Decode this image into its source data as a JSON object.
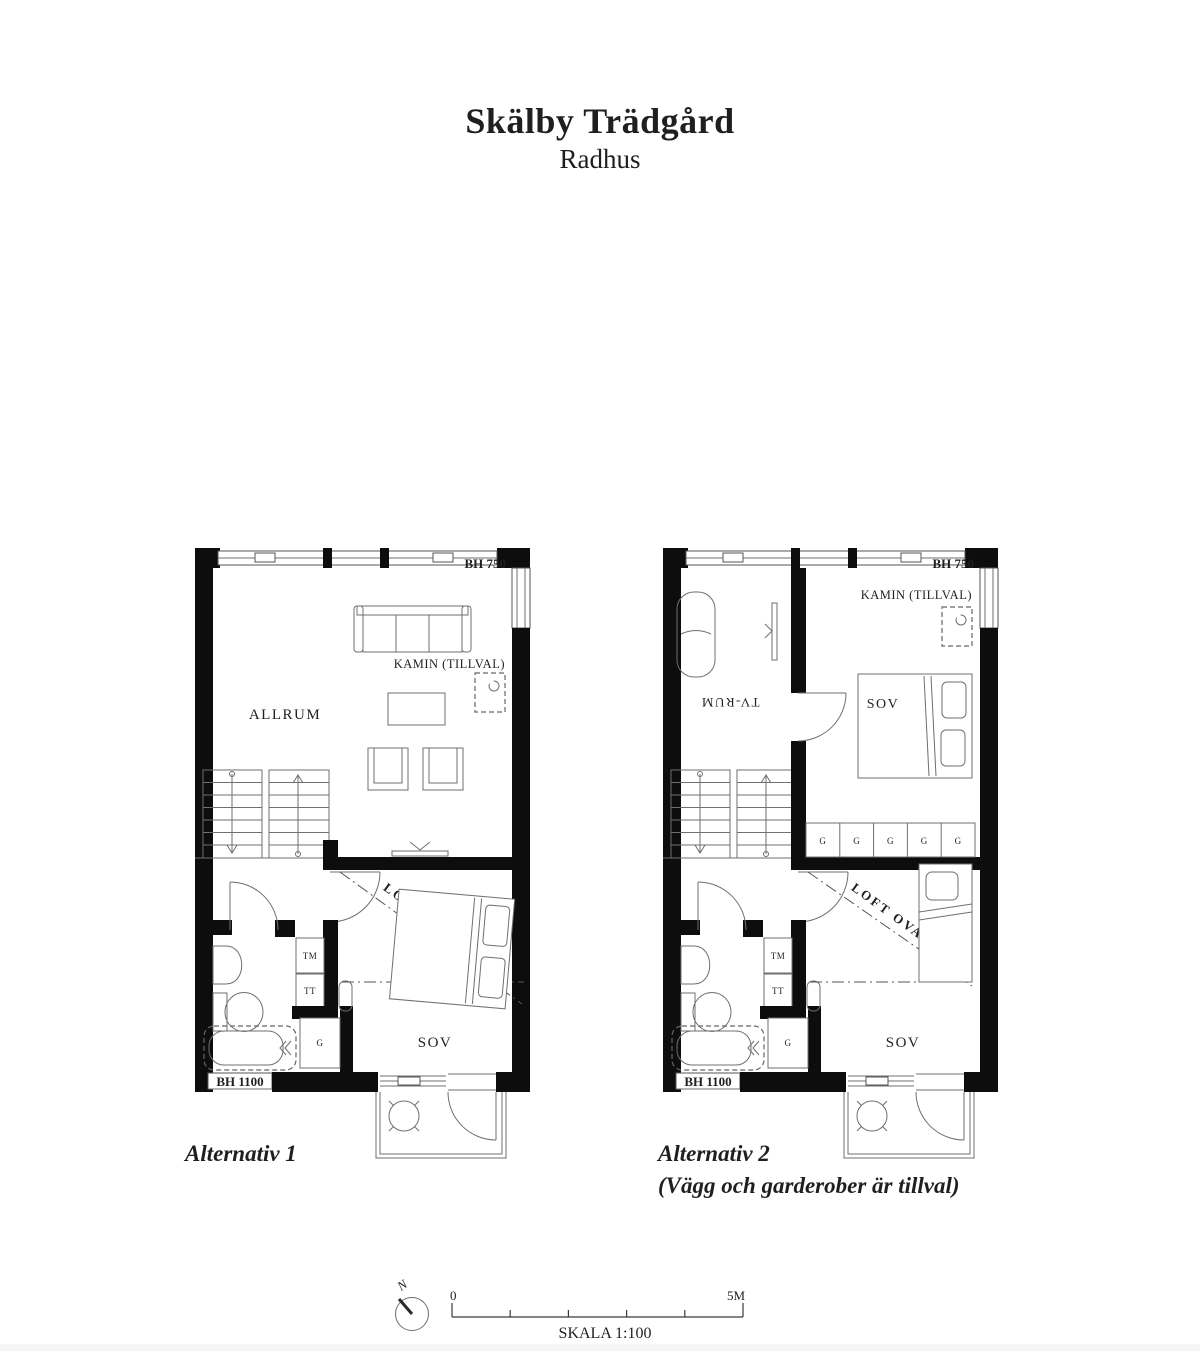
{
  "title": {
    "main": "Skälby Trädgård",
    "subtitle": "Radhus"
  },
  "plan_labels": {
    "bh750": "BH 750",
    "bh1100": "BH 1100",
    "kamin_tillval": "KAMIN (TILLVAL)",
    "allrum": "ALLRUM",
    "tv_rum": "TV-RUM",
    "sov": "SOV",
    "loft_ovan": "LOFT OVAN",
    "tm": "TM",
    "tt": "TT",
    "g": "G"
  },
  "captions": {
    "alt1": "Alternativ 1",
    "alt2": "Alternativ 2",
    "alt2_note": "(Vägg och garderober är tillval)"
  },
  "footer": {
    "north": "N",
    "scale_start": "0",
    "scale_end": "5M",
    "scale_label": "SKALA 1:100"
  },
  "colors": {
    "ink": "#1f1f1f",
    "wall": "#0d0d0d",
    "line": "#6f6f6f",
    "page": "#ffffff"
  }
}
